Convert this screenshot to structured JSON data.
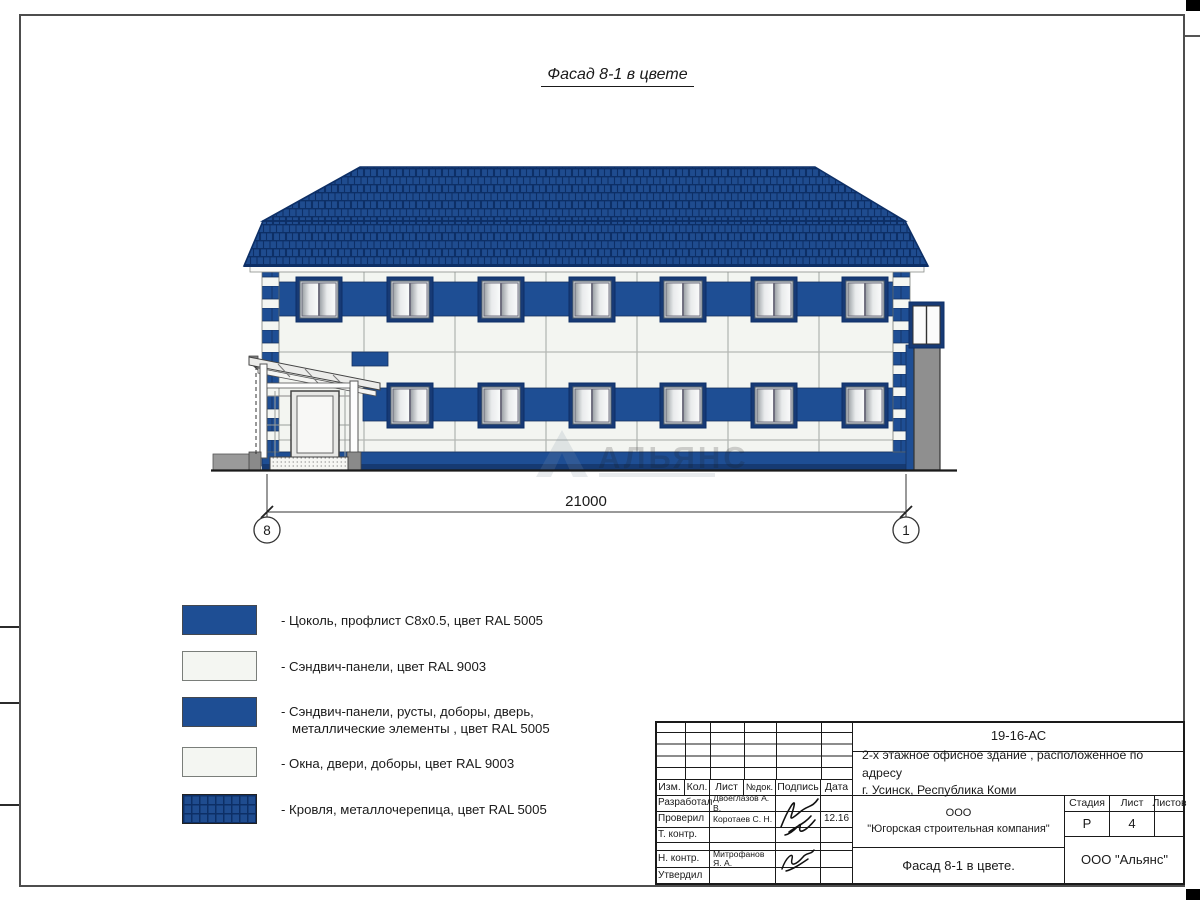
{
  "page": {
    "title": "Фасад 8-1 в цвете"
  },
  "drawing": {
    "dimension": "21000",
    "axis_left": "8",
    "axis_right": "1",
    "watermark": "АЛЬЯНС"
  },
  "legend": {
    "items": [
      {
        "swatch": "blue",
        "label": "- Цоколь, профлист С8х0.5, цвет RAL 5005"
      },
      {
        "swatch": "white",
        "label": "- Сэндвич-панели, цвет RAL 9003"
      },
      {
        "swatch": "blue",
        "label_line1": "- Сэндвич-панели, русты, доборы, дверь,",
        "label_line2": "металлические элементы , цвет RAL 5005"
      },
      {
        "swatch": "white",
        "label": "- Окна, двери, доборы, цвет RAL 9003"
      },
      {
        "swatch": "roof",
        "label": "- Кровля, металлочерепица, цвет RAL 5005"
      }
    ]
  },
  "title_block": {
    "doc_code": "19-16-АС",
    "project_line1": "2-х этажное офисное здание , расположенное по адресу",
    "project_line2": "г. Усинск, Республика Коми",
    "columns": {
      "izm": "Изм.",
      "kol": "Кол.",
      "list": "Лист",
      "ndoc": "№док.",
      "podpis": "Подпись",
      "data": "Дата"
    },
    "rows": [
      {
        "role": "Разработал",
        "name": "Двоеглазов А. В.",
        "date": ""
      },
      {
        "role": "Проверил",
        "name": "Коротаев С. Н.",
        "date": "12.16"
      },
      {
        "role": "Т. контр.",
        "name": "",
        "date": ""
      },
      {
        "role": "Н. контр.",
        "name": "Митрофанов Я. А.",
        "date": ""
      },
      {
        "role": "Утвердил",
        "name": "",
        "date": ""
      }
    ],
    "company_line1": "ООО",
    "company_line2": "\"Югорская строительная компания\"",
    "stage_label": "Стадия",
    "sheet_label": "Лист",
    "sheets_label": "Листов",
    "stage_value": "Р",
    "sheet_value": "4",
    "sheets_value": "",
    "drawing_title": "Фасад 8-1 в цвете.",
    "org_name": "ООО \"Альянс\""
  },
  "colors": {
    "ral5005_panels": "#1e4e94",
    "ral5005_roof": "#1f4c8f",
    "ral9003": "#f4f6f2",
    "window_frame": "#173a75",
    "metal_gray": "#8f8f8f"
  }
}
